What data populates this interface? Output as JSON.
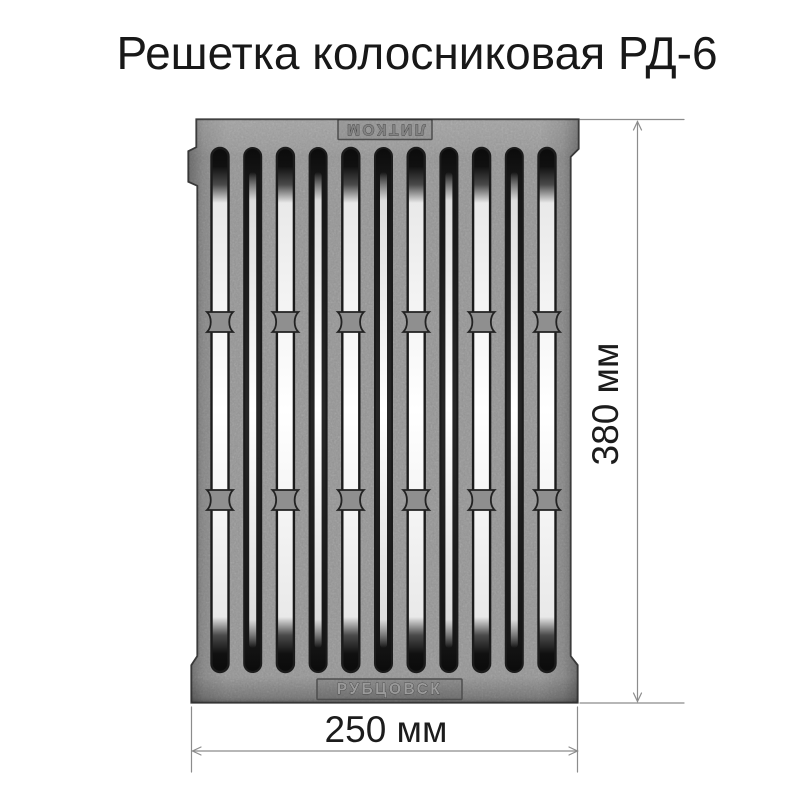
{
  "title": "Решетка колосниковая РД-6",
  "grate": {
    "top_marking": "ЛИТКОМ",
    "bottom_marking": "РУБЦОВСК",
    "colors": {
      "iron_base": "#959595",
      "iron_rim": "#383838",
      "slot_dark": "#0b0b0b",
      "slot_light": "#ffffff",
      "bridge": "#8f8f8f"
    }
  },
  "dimensions": {
    "height": {
      "label": "380 мм"
    },
    "width": {
      "label": "250 мм"
    },
    "line_color": "#8c8c8c",
    "text_color": "#1c1c1c"
  }
}
